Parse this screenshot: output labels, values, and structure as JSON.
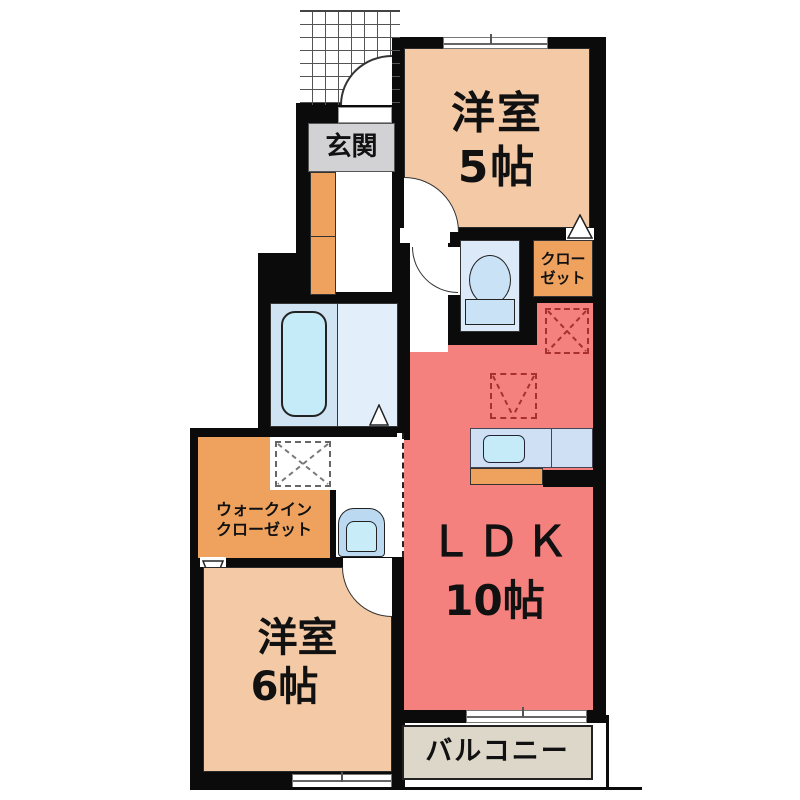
{
  "plan": {
    "title": "apartment-floor-plan",
    "rooms": {
      "genkan": {
        "label": "玄関"
      },
      "room5": {
        "label": "洋室",
        "size": "5帖"
      },
      "closet": {
        "line1": "クロー",
        "line2": "ゼット"
      },
      "ldk": {
        "label": "ＬＤＫ",
        "size": "10帖"
      },
      "walkin": {
        "line1": "ウォークイン",
        "line2": "クローゼット"
      },
      "room6": {
        "label": "洋室",
        "size": "6帖"
      },
      "balcony": {
        "label": "バルコニー"
      }
    },
    "fixtures": [
      "toilet",
      "bathtub",
      "washbasin",
      "kitchen-sink",
      "washing-machine-space",
      "refrigerator-space",
      "shoe-cabinet"
    ],
    "colors": {
      "wall": "#0b0b0b",
      "room_peach": "#f3c9a6",
      "ldk_red": "#f5817f",
      "closet_orange": "#efa25e",
      "genkan_gray": "#d2d2d4",
      "bath_blue": "#cfe3f2",
      "wet_blue": "#e2eef9",
      "water_cyan": "#c5ebf8",
      "balcony_beige": "#ddd7ca"
    }
  }
}
